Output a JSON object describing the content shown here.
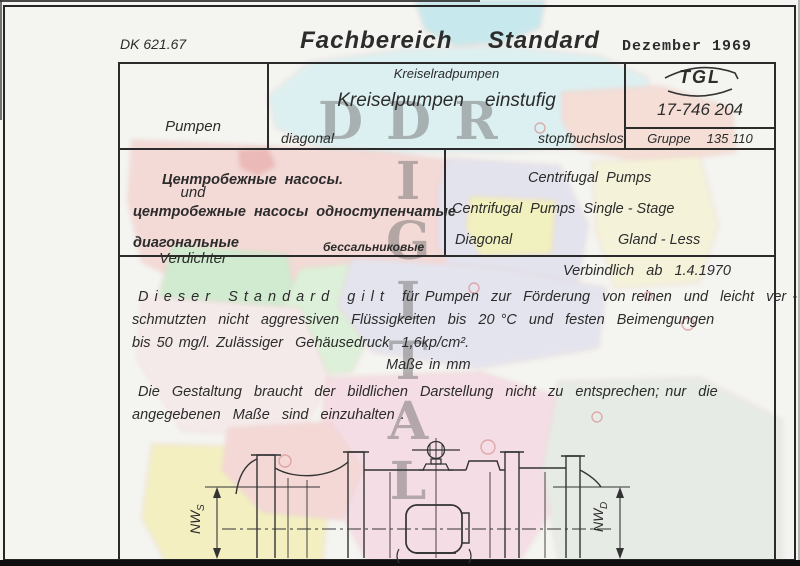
{
  "page": {
    "doc_class": "DK 621.67",
    "title": "Fachbereich  Standard",
    "date": "Dezember 1969"
  },
  "title_block": {
    "subject": [
      "Pumpen",
      "und",
      "Verdichter"
    ],
    "family": "Kreiselradpumpen",
    "main_title": "Kreiselpumpen    einstufig",
    "variant_left": "diagonal",
    "variant_right": "stopfbuchslos",
    "standard_org": "TGL",
    "standard_number": "17-746 204",
    "group_label": "Gruppe",
    "group_number": "135 110"
  },
  "translations": {
    "ru_line1": "Центробежные  насосы.",
    "ru_line2": "центробежные  насосы  одноступенчатые",
    "ru_line3a": "диагональные",
    "ru_line3b": "бессальниковые",
    "en_line1": "Centrifugal  Pumps",
    "en_line2": "Centrifugal  Pumps  Single - Stage",
    "en_line3a": "Diagonal",
    "en_line3b": "Gland - Less"
  },
  "validity": "Verbindlich  ab  1.4.1970",
  "scope": {
    "line1": "D i e s e r   S t a n d a r d   g i l t   für Pumpen  zur  Förderung  von reinen  und  leicht  ver -",
    "line2": "schmutzten  nicht  aggressiven  Flüssigkeiten  bis  20 °C  und  festen  Beimengungen",
    "line3": "bis 50 mg/l. Zulässiger  Gehäusedruck  1,6kp/cm².",
    "units_note": "Maße in mm",
    "note_line1": "Die  Gestaltung  braucht  der  bildlichen  Darstellung  nicht  zu  entsprechen; nur  die",
    "note_line2": "angegebenen  Maße  sind  einzuhalten ."
  },
  "drawing": {
    "dim_left_main": "NW",
    "dim_left_sub": "S",
    "dim_right_main": "NW",
    "dim_right_sub": "D"
  },
  "watermark": {
    "horizontal": "DDR",
    "vertical": "DIGITAL",
    "color": "#6e6e6e",
    "map_palette": [
      "#a8e1ea",
      "#cdeef2",
      "#f4c8c5",
      "#e59090",
      "#d8d8ee",
      "#f0ee9c",
      "#f6f2cb",
      "#f5cfc4",
      "#b7e5b9",
      "#dadaee",
      "#f7e4e6",
      "#f6cede",
      "#f3eda0",
      "#dee6df"
    ]
  }
}
